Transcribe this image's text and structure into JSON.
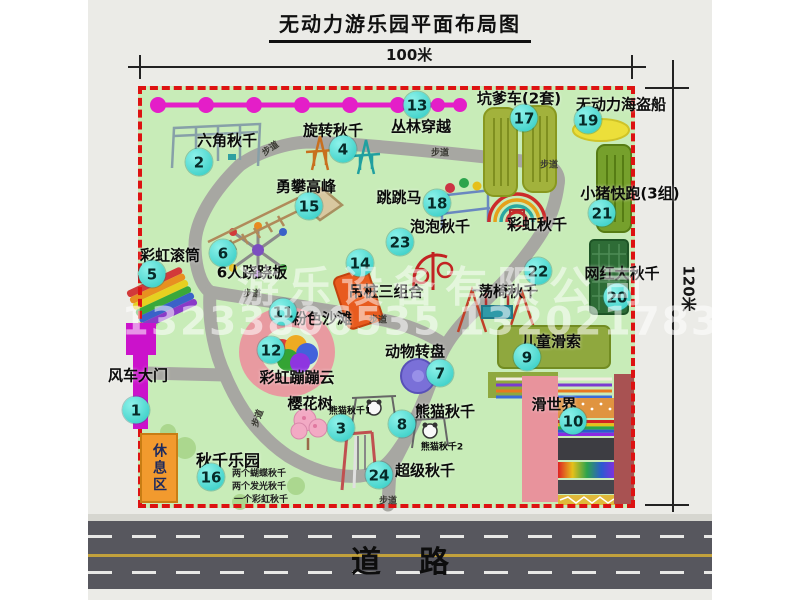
{
  "title": "无动力游乐园平面布局图",
  "dimensions": {
    "width_label": "100米",
    "height_label": "120米"
  },
  "road": {
    "label": "道路"
  },
  "watermark": {
    "company": "游乐设备有限公司",
    "phone": "13233806535 13202178333"
  },
  "rest_area": {
    "label": "休息区"
  },
  "map": {
    "trail_label": "步道",
    "rainbow_swing_label": "彩虹秋千",
    "items": [
      {
        "num": "1",
        "label": "风车大门"
      },
      {
        "num": "2",
        "label": "六角秋千"
      },
      {
        "num": "3",
        "label": "樱花树"
      },
      {
        "num": "4",
        "label": "旋转秋千"
      },
      {
        "num": "5",
        "label": "彩虹滚筒"
      },
      {
        "num": "6",
        "label": "6人跷跷板"
      },
      {
        "num": "7",
        "label": "动物转盘"
      },
      {
        "num": "8",
        "label": "熊猫秋千",
        "notes": [
          "熊猫秋千1",
          "熊猫秋千2"
        ]
      },
      {
        "num": "9",
        "label": "儿童滑索"
      },
      {
        "num": "10",
        "label": "滑世界"
      },
      {
        "num": "11",
        "label": "粉色沙滩"
      },
      {
        "num": "12",
        "label": "彩虹蹦蹦云"
      },
      {
        "num": "13",
        "label": "丛林穿越"
      },
      {
        "num": "14",
        "label": "吊桩三组合"
      },
      {
        "num": "15",
        "label": "勇攀高峰"
      },
      {
        "num": "16",
        "label": "秋千乐园",
        "notes": [
          "两个蝴蝶秋千",
          "两个发光秋千",
          "一个彩虹秋千"
        ]
      },
      {
        "num": "17",
        "label": "坑爹车(2套)"
      },
      {
        "num": "18",
        "label": "跳跳马"
      },
      {
        "num": "19",
        "label": "无动力海盗船"
      },
      {
        "num": "20",
        "label": "网红大秋千"
      },
      {
        "num": "21",
        "label": "小猪快跑(3组)"
      },
      {
        "num": "22",
        "label": "荡椅秋千"
      },
      {
        "num": "23",
        "label": "泡泡秋千"
      },
      {
        "num": "24",
        "label": "超级秋千"
      }
    ]
  },
  "colors": {
    "park_green": "#c8ecb8",
    "border_red": "#dd1212",
    "badge_cyan": "#3fdcd4",
    "zipline_magenta": "#e41ec8",
    "gate_magenta": "#cb12cb",
    "rest_orange": "#f29a2e",
    "road_gray": "#57575e"
  }
}
